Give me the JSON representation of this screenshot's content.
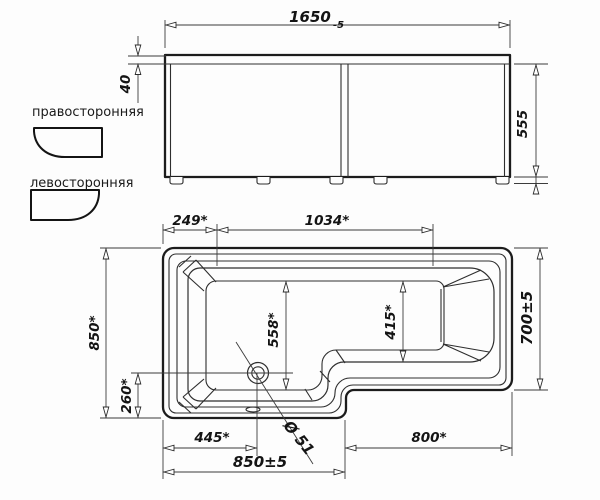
{
  "drawing": {
    "background": "#fdfdfd",
    "line_color": "#1c1c1c",
    "dim_color": "#3c3c3c",
    "subject": "l-shaped-bathtub-technical-drawing"
  },
  "legend": {
    "right_label": "правосторонняя",
    "left_label": "левосторонняя",
    "right_icon": "right-orientation-tub-icon",
    "left_icon": "left-orientation-tub-icon"
  },
  "front_view": {
    "length": "1650",
    "length_tolerance": "-5",
    "apron_height": "40",
    "height": "555"
  },
  "plan_view": {
    "left_offset": "249*",
    "inner_length": "1034*",
    "width_total": "850*",
    "drain_from_bottom": "260*",
    "inner_width_left": "558*",
    "inner_width_right": "415*",
    "width_right": "700±5",
    "drain_from_left": "445*",
    "left_section_length": "850±5",
    "right_section_length": "800*",
    "drain_diameter": "Ø 51"
  }
}
